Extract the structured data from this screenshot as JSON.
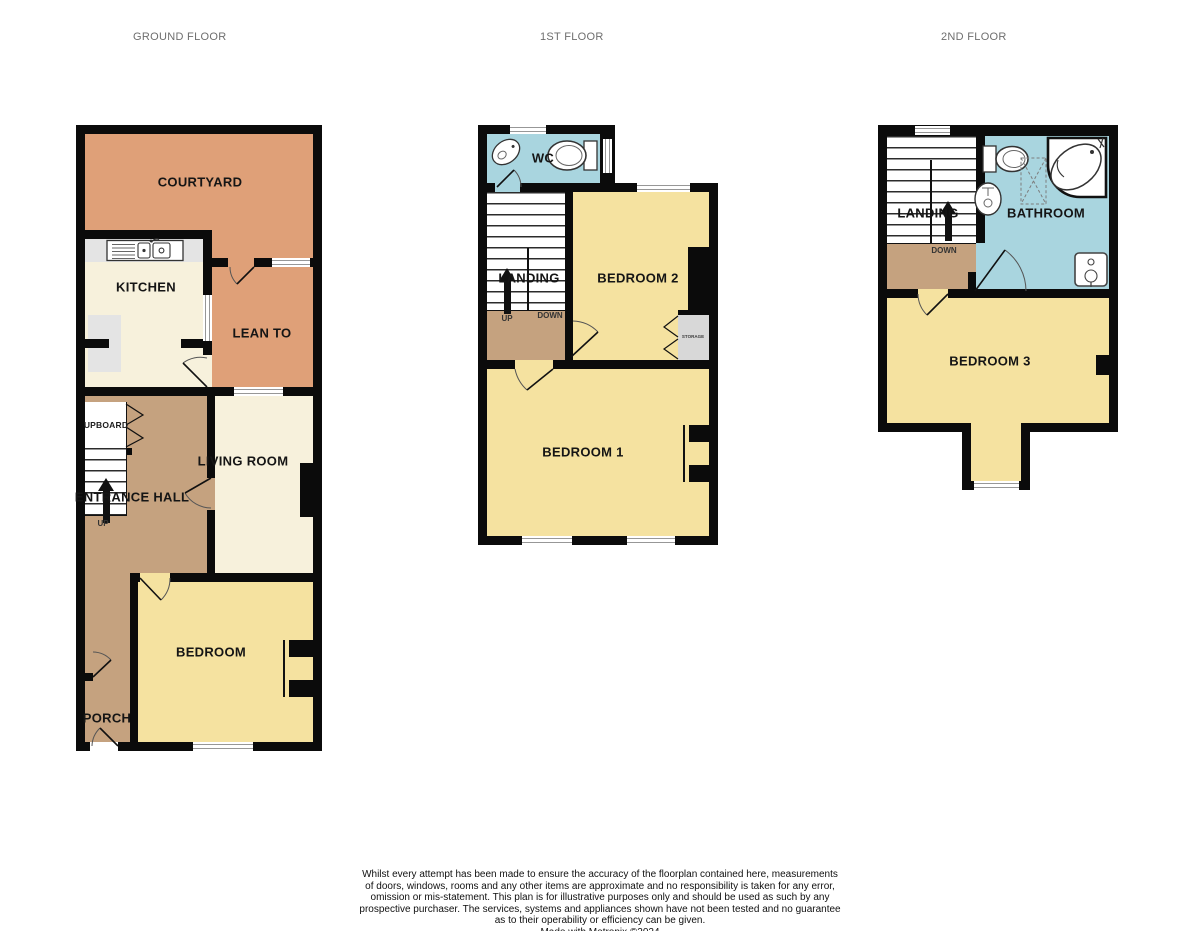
{
  "titles": {
    "ground": "GROUND FLOOR",
    "first": "1ST FLOOR",
    "second": "2ND FLOOR"
  },
  "ground_floor": {
    "courtyard": "COURTYARD",
    "kitchen": "KITCHEN",
    "lean_to": "LEAN TO",
    "cupboard": "UPBOARD",
    "living_room": "LIVING ROOM",
    "entrance_hall": "ENTRANCE HALL",
    "bedroom": "BEDROOM",
    "porch": "PORCH",
    "up": "UP"
  },
  "first_floor": {
    "wc": "WC",
    "landing": "LANDING",
    "bedroom_2": "BEDROOM 2",
    "bedroom_1": "BEDROOM 1",
    "storage": "STORAGE",
    "up": "UP",
    "down": "DOWN"
  },
  "second_floor": {
    "landing": "LANDING",
    "bathroom": "BATHROOM",
    "bedroom_3": "BEDROOM 3",
    "down": "DOWN"
  },
  "disclaimer": {
    "lines": [
      "Whilst every attempt has been made to ensure the accuracy of the floorplan contained here, measurements",
      "of doors, windows, rooms and any other items are approximate and no responsibility is taken for any error,",
      "omission or mis-statement. This plan is for illustrative purposes only and should be used as such by any",
      "prospective purchaser. The services, systems and appliances shown have not been tested and no guarantee",
      "as to their operability or efficiency can be given."
    ],
    "credit": "Made with Metropix ©2024"
  },
  "colors": {
    "wall": "#0b0b0b",
    "courtyard_orange": "#DFA078",
    "room_cream": "#F7F1DC",
    "bedroom_yellow": "#F5E2A0",
    "hall_tan": "#C5A27F",
    "bathroom_blue": "#A9D5DF",
    "counter_gray": "#E4E4E4",
    "storage_gray": "#D8D8D8"
  }
}
